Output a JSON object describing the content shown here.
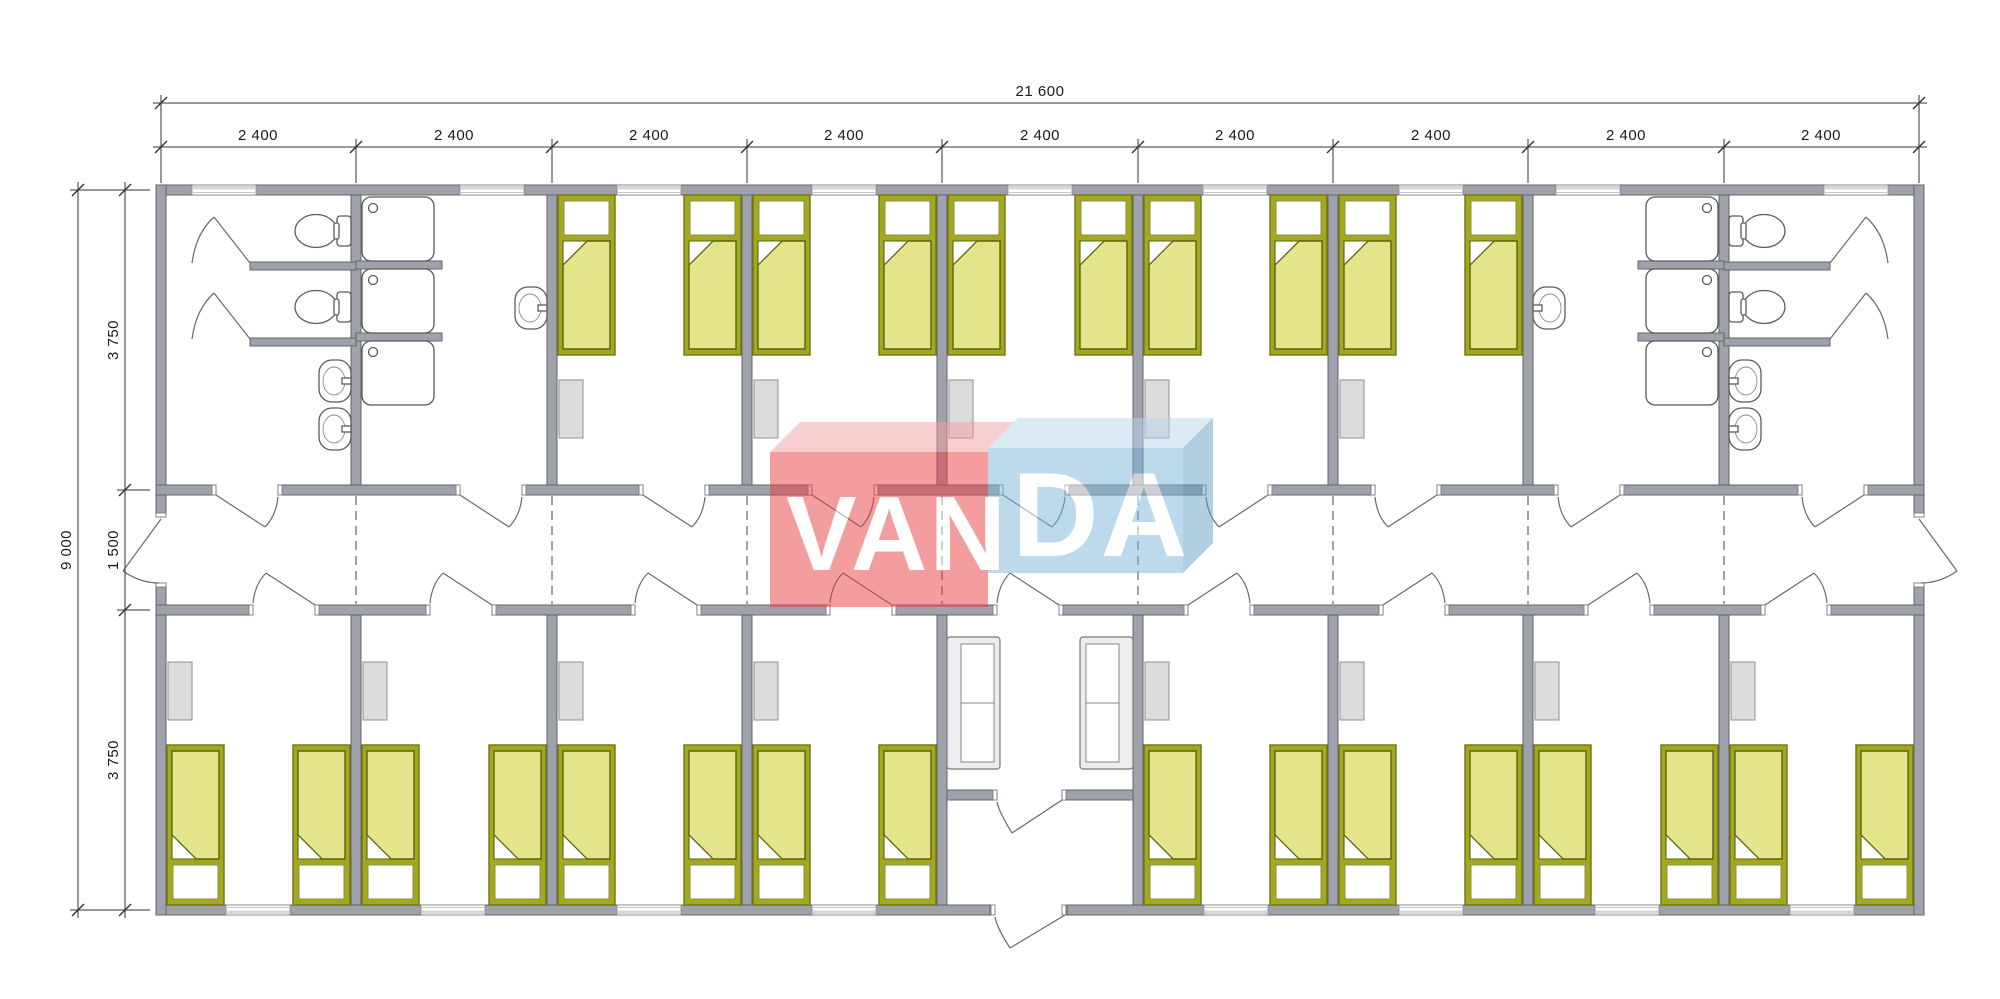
{
  "document": {
    "type": "architectural-floor-plan",
    "description": "Modular dormitory building plan, 9 modules, central corridor, bedrooms with single beds, WC and shower rooms at both ends, central entrance lobby with sofas",
    "background": "#ffffff"
  },
  "brand": {
    "full": "VANDA",
    "left": "VAN",
    "right": "DA"
  },
  "dimensions": {
    "total_width": "21 600",
    "module_width": "2 400",
    "modules_count": 9,
    "total_height": "9 000",
    "top_row": "3 750",
    "corridor": "1 500",
    "bottom_row": "3 750"
  },
  "colors": {
    "wall": "#9fa1ab",
    "wall_outline": "#63656e",
    "bed_frame": "#a3a81f",
    "bed_mattress": "#e4e58a",
    "bed_mattress_outline": "#5d6212",
    "wardrobe": "#dcdcdc",
    "fixture_line": "#5a5a5a",
    "logo_red_front": "#ea3d41",
    "logo_red_top": "#f2a0a3",
    "logo_blue_front": "#7db5da",
    "logo_blue_top": "#b6d8ee",
    "logo_blue_side": "#669fc6"
  },
  "symbols": {
    "bed_count": 26,
    "shower_count": 6,
    "toilet_count": 4,
    "sink_count": 8,
    "wardrobe_count": 13,
    "sofa_count": 2,
    "window_count": 17,
    "door_count": 24
  }
}
